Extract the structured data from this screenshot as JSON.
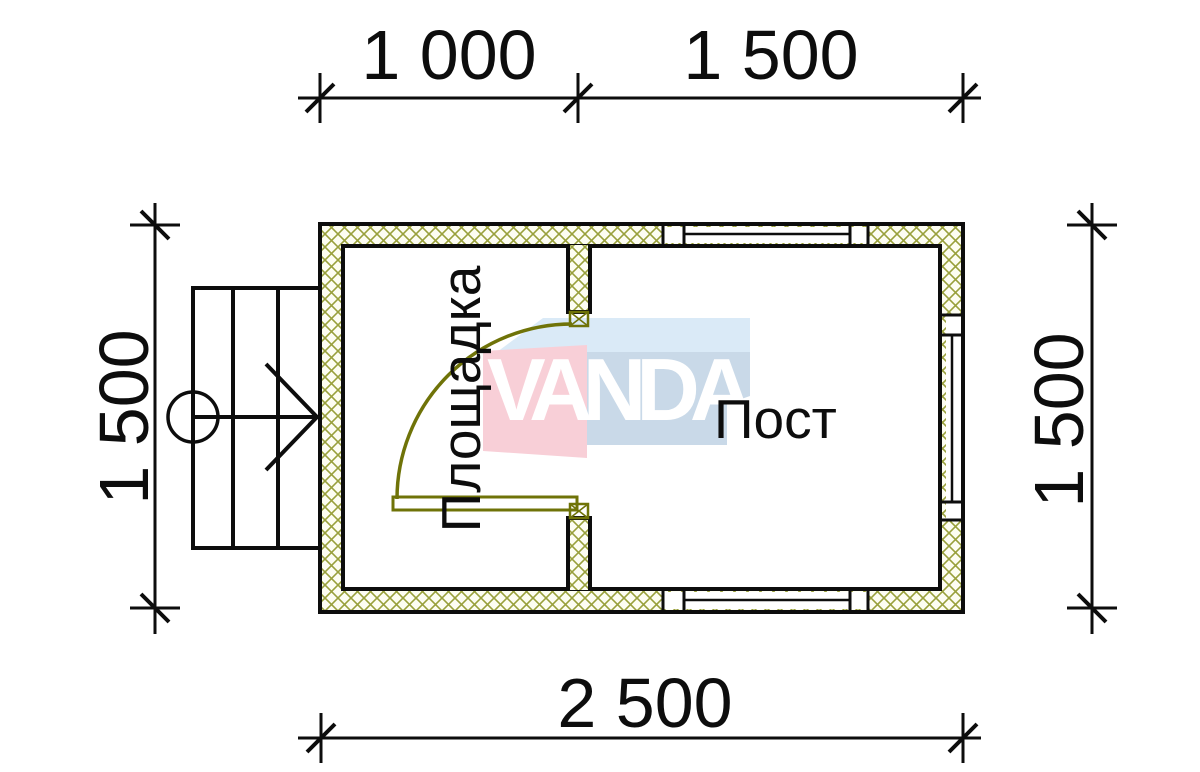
{
  "drawing": {
    "type": "architectural-floor-plan",
    "rooms": [
      {
        "label": "Площадка"
      },
      {
        "label": "Пост"
      }
    ],
    "watermark": {
      "text": "VANDA"
    },
    "dimensions": {
      "top_segments": [
        {
          "label": "1 000"
        },
        {
          "label": "1 500"
        }
      ],
      "bottom": {
        "label": "2 500"
      },
      "left": {
        "label": "1 500"
      },
      "right": {
        "label": "1 500"
      }
    }
  },
  "colors": {
    "ink": "#0d0d0d",
    "hatch": "#99a03c",
    "hatch_bg": "#fdfdf2",
    "door": "#6f7308",
    "wm_blue_light": "#daeaf7",
    "wm_blue": "#c9d9e8",
    "wm_pink": "#f8cfd7"
  }
}
